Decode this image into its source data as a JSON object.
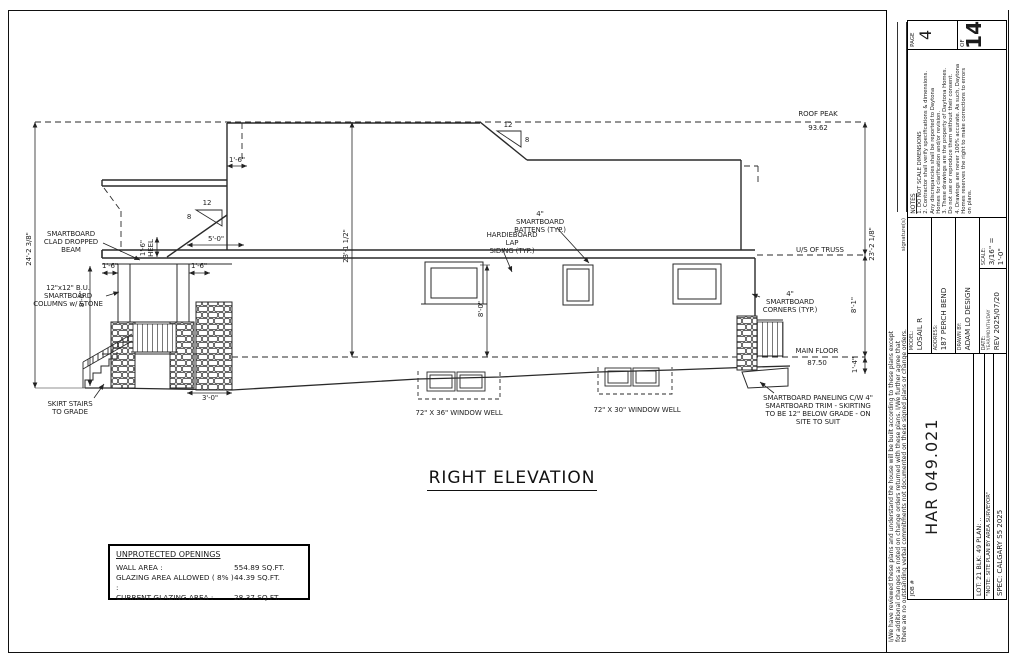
{
  "page": {
    "drawing_title": "RIGHT ELEVATION"
  },
  "elevation": {
    "roof_peak_label": "ROOF PEAK",
    "roof_peak_value": "93.62",
    "us_of_truss_label": "U/S OF TRUSS",
    "main_floor_label": "MAIN FLOOR",
    "main_floor_value": "87.50",
    "pitch_rise_upper": "12",
    "pitch_run_upper": "8",
    "pitch_rise_lower": "12",
    "pitch_run_lower": "8",
    "callout_battens": "4\" SMARTBOARD\nBATTENS (TYP.)",
    "callout_siding": "HARDIEBOARD LAP\nSIDING (TYP.)",
    "callout_corners": "4\" SMARTBOARD\nCORNERS (TYP.)",
    "callout_beam": "SMARTBOARD\nCLAD DROPPED\nBEAM",
    "callout_columns": "12\"x12\" B.U.\nSMARTBOARD\nCOLUMNS w/ STONE",
    "callout_skirt_stairs": "SKIRT STAIRS\nTO GRADE",
    "callout_paneling": "SMARTBOARD PANELING C/W 4\"\nSMARTBOARD TRIM - SKIRTING\nTO BE 12\" BELOW GRADE - ON\nSITE TO SUIT",
    "window_well_left": "72\" X 36\" WINDOW WELL",
    "window_well_right": "72\" X 30\" WINDOW WELL",
    "dim_overall_left": "24'-2 3/8\"",
    "dim_mid_total": "23'-1 1/2\"",
    "dim_right_total": "23'-2 1/8\"",
    "dim_wall_height": "8'-1\"",
    "dim_below_floor": "1'-4\"",
    "dim_window_height": "8'-0\"",
    "dim_porch_height": "8'-0\"",
    "dim_heel": "1'-6\"\nHEEL",
    "dim_5_0": "5'-0\"",
    "dim_1_6_top": "1'-6\"",
    "dim_1_6_left": "1'-6\"",
    "dim_1_6_right": "1'-6\"",
    "dim_3_0": "3'-0\""
  },
  "openings_table": {
    "title": "UNPROTECTED OPENINGS",
    "rows": [
      {
        "label": "WALL AREA :",
        "value": "554.89 SQ.FT."
      },
      {
        "label": "GLAZING AREA ALLOWED ( 8% ) :",
        "value": "44.39 SQ.FT."
      },
      {
        "label": "CURRENT GLAZING AREA :",
        "value": "28.37 SQ.FT."
      }
    ]
  },
  "title_block": {
    "disclaimer": "I/We have reviewed these plans and understand the house will be built according to these plans except\nfor additional changes as noted on change orders returned with these plans. I/We further agree that\nthere are no outstanding verbal commitments not documented on these signed plans or change orders.",
    "signature_label": "signature(s)",
    "job_label": "JOB #",
    "job_number": "HAR 049.021",
    "lot_line": "LOT: 21     BLK: 49     PLAN: ..",
    "site_note": "\"NOTE: SITE PLAN BY AREA SURVEYOR\"",
    "spec_line": "SPEC: CALGARY S5 2025",
    "model_label": "MODEL:",
    "model_value": "LOSAIL R",
    "address_label": "ADDRESS:",
    "address_value": "187 PERCH BEND",
    "drawn_by_label": "DRAWN BY:",
    "drawn_by_value": "ADAM LO DESIGN",
    "date_label": "DATE:",
    "date_format": "YEAR/MONTH/DAY",
    "date_value": "REV 2025/07/20",
    "scale_label": "SCALE:",
    "scale_value": "3/16\" = 1'-0\"",
    "notes_title": "NOTES",
    "notes_body": "1. DO NOT SCALE DIMENSIONS\n2. Contractor shall verify specifications & dimensions.\nAny discrepancies shall be reported to Daytona\nHomes for clarification and/or revision.\n3. These drawings are the property of Daytona Homes.\nDo not use or reproduce them without their consent.\n4. Drawings are never 100% accurate. As such, Daytona\nHomes reserves the right to make corrections to errors\non plans.",
    "page_label": "PAGE",
    "page_value": "4",
    "of_label": "OF",
    "of_value": "14"
  },
  "colors": {
    "line": "#2a2a2a",
    "paper": "#ffffff"
  }
}
